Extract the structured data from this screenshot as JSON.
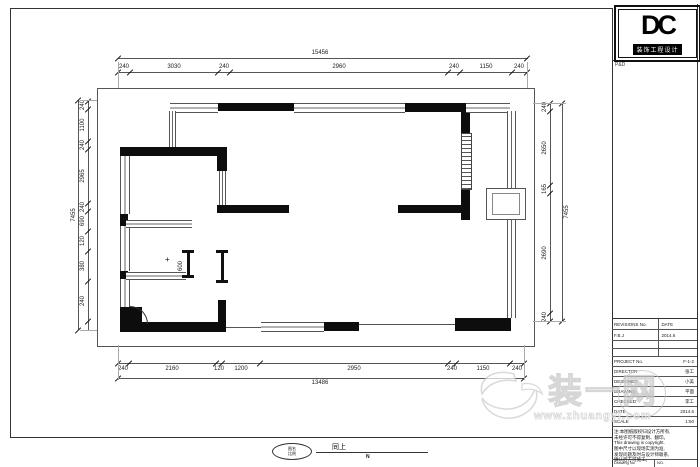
{
  "logo": {
    "text": "DC",
    "bar_text": "装饰工程设计",
    "sub_text": "P&D"
  },
  "dims": {
    "top_total": "15456",
    "top": [
      "240",
      "3030",
      "240",
      "2960",
      "240",
      "1150",
      "240"
    ],
    "bottom": [
      "240",
      "2160",
      "120",
      "1200",
      "2950",
      "240",
      "1150",
      "240"
    ],
    "bottom_total": "13486",
    "left": [
      "240",
      "1100",
      "240",
      "2965",
      "240",
      "690",
      "120",
      "380",
      "240"
    ],
    "left_total": "7455",
    "right": [
      "240",
      "2650",
      "165",
      "2690",
      "240"
    ],
    "right_total": "7455",
    "interior": [
      "600"
    ],
    "interior_mark": "+"
  },
  "plan_label": {
    "e1": "图名",
    "e2": "比例",
    "title": "同上",
    "sub": "N"
  },
  "title_block": {
    "rows": [
      {
        "label": "REVISIONS No.",
        "value": "DATE"
      },
      {
        "label": "F.B.J",
        "value": "2014.6"
      },
      {
        "label": "",
        "value": ""
      },
      {
        "label": "",
        "value": ""
      },
      {
        "label": "PROJECT No.",
        "value": "F-1-2"
      },
      {
        "label": "DIRECTOR",
        "value": "张工"
      },
      {
        "label": "DESIGNER",
        "value": "小美"
      },
      {
        "label": "DRAWING",
        "value": "平面"
      },
      {
        "label": "CHECKED",
        "value": "李工"
      },
      {
        "label": "DATE",
        "value": "2014.6"
      },
      {
        "label": "SCALE",
        "value": "1:50"
      }
    ],
    "notes": [
      "注:本图纸版权归设计方所有,",
      "未经许可不得复制、翻印。",
      "This drawing is copyright.",
      "图中尺寸以现场实测为准,",
      "发现问题及时与设计师联系,",
      "确认后方可施工。"
    ],
    "footer": {
      "left_en": "Drawing No",
      "left_cn": "图号",
      "right_en": "NO.",
      "right_cn": "递号"
    }
  },
  "watermark": {
    "text": "装一网",
    "url": "www.zhuangyi.com",
    "stamp": "装一网"
  }
}
